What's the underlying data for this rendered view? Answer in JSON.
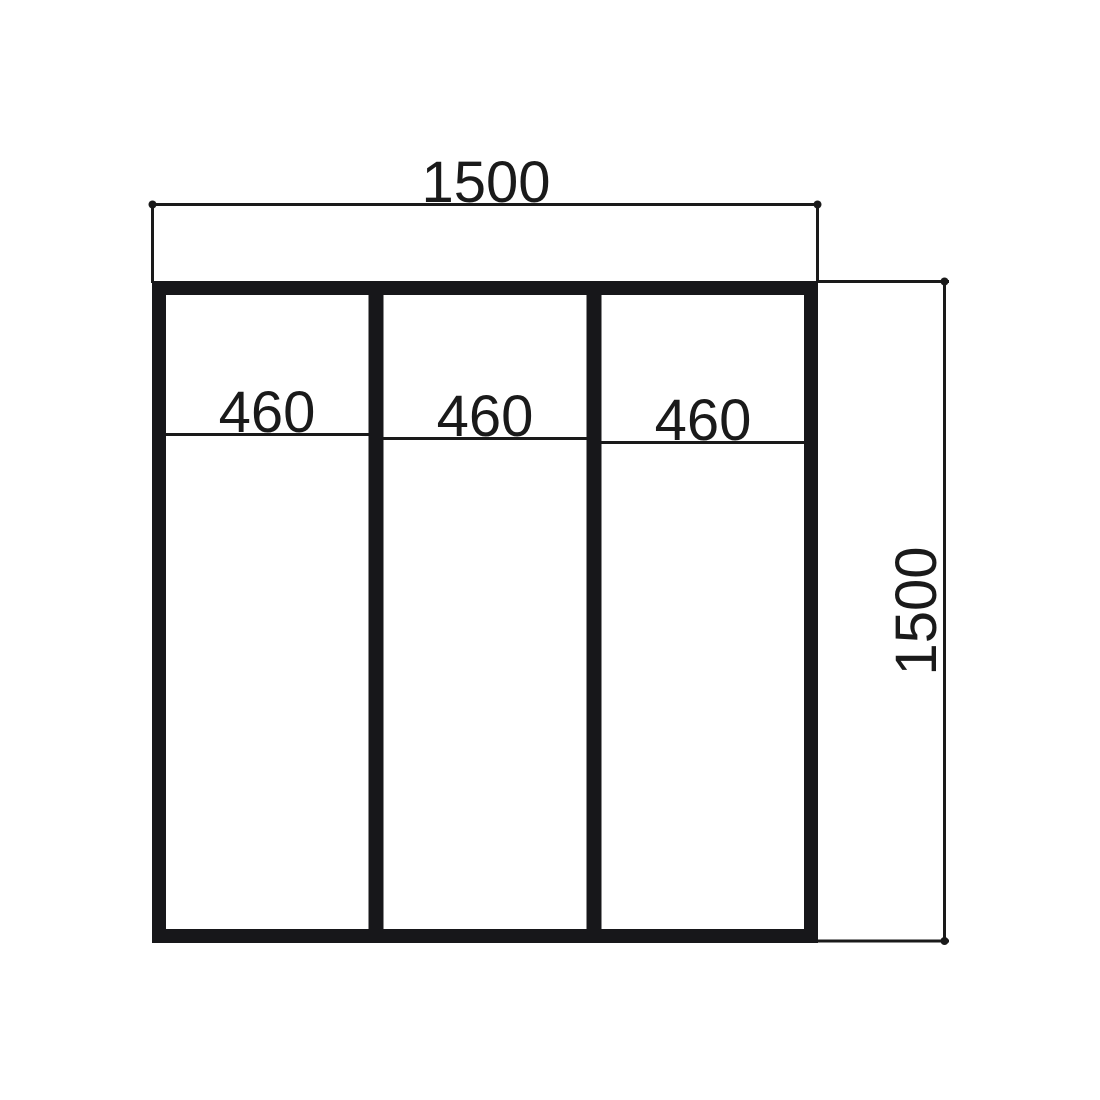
{
  "drawing": {
    "kind": "technical-dimension-drawing",
    "subject": "three-panel square frame elevation",
    "colors": {
      "line": "#1a1a1a",
      "frame": "#17171a",
      "background": "#ffffff"
    },
    "overall": {
      "width_label": "1500",
      "height_label": "1500"
    },
    "panels": [
      {
        "label": "460"
      },
      {
        "label": "460"
      },
      {
        "label": "460"
      }
    ]
  }
}
